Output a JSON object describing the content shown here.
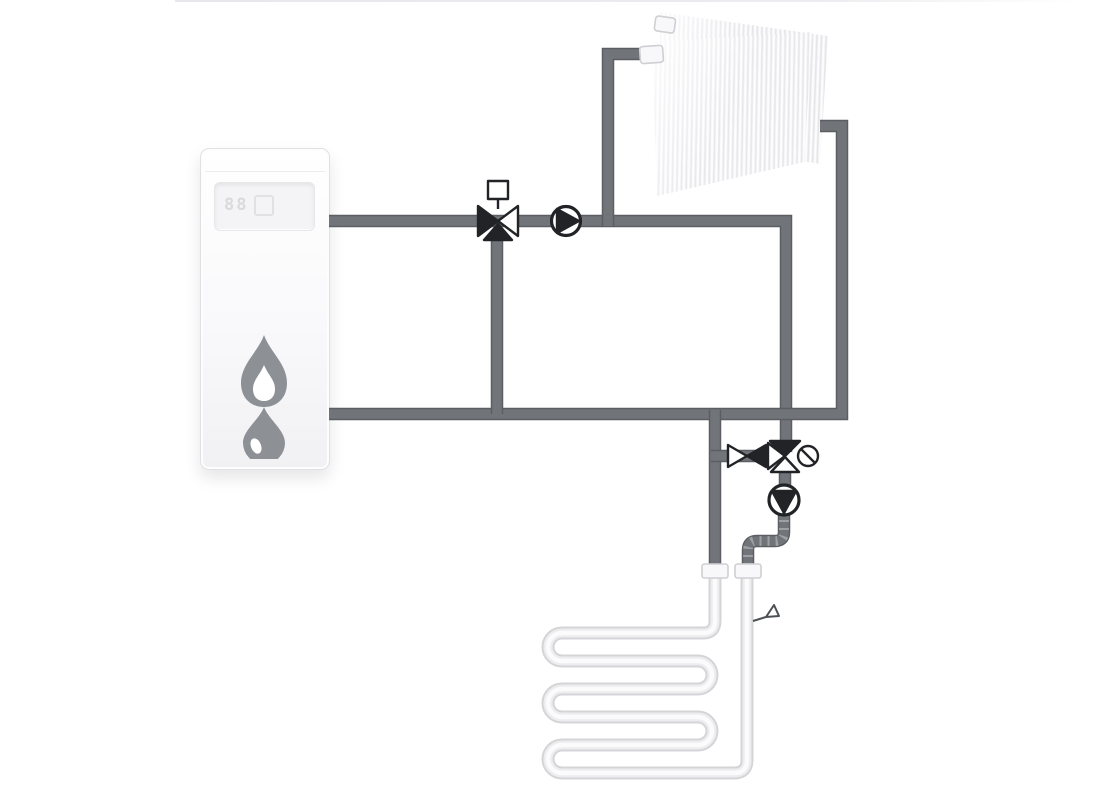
{
  "diagram": {
    "type": "hydraulic-heating-schematic",
    "description": "Boiler feeding a radiator circuit and a mixed underfloor-heating circuit",
    "boiler": {
      "label": "wall-hung gas boiler",
      "display_text": "88"
    },
    "components": [
      {
        "id": "boiler",
        "label": "gas boiler with flame and water-drop symbol"
      },
      {
        "id": "mixing-valve-1",
        "label": "3-way mixing valve with square actuator (boiler supply)"
      },
      {
        "id": "pump-1",
        "label": "circulation pump, flow to the right (radiator circuit)"
      },
      {
        "id": "radiator",
        "label": "double panel radiator"
      },
      {
        "id": "shutoff-valve",
        "label": "two-way shut-off valve (floor circuit branch)"
      },
      {
        "id": "mixing-valve-2",
        "label": "3-way mixing valve with rotary actuator (floor circuit)"
      },
      {
        "id": "pump-2",
        "label": "circulation pump, flow downward (floor circuit)"
      },
      {
        "id": "manifold-fittings",
        "label": "two white connection fittings to floor loop"
      },
      {
        "id": "underfloor-coil",
        "label": "serpentine underfloor heating pipe loop, 6 passes"
      },
      {
        "id": "vent-valve",
        "label": "small drain / air-vent valve on floor-loop return"
      }
    ],
    "colors": {
      "pipe": "#71757a",
      "pipe_edge": "#5b5f63",
      "symbol": "#222326",
      "coil_outer": "#d5d5d8",
      "coil_mid": "#ededef",
      "coil_core": "#fbfbfc",
      "flame": "#8d9196",
      "background": "#ffffff"
    }
  }
}
